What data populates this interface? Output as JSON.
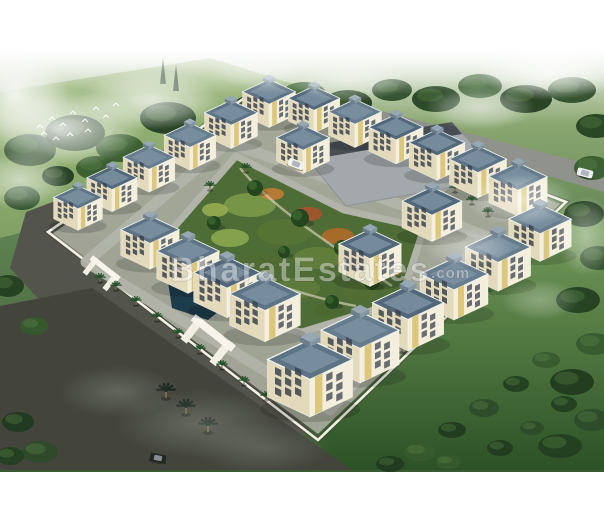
{
  "meta": {
    "width": 604,
    "height": 520
  },
  "watermark": {
    "text": "BharatEstates",
    "suffix": ".com"
  },
  "palette": {
    "bgTop": "#f3f6ef",
    "green1": "#8aa771",
    "green2": "#5d8150",
    "green3": "#49693e",
    "green4": "#3a5a33",
    "field": "#93b06f",
    "lawnLight": "#79a05e",
    "lawnDark": "#2c5126",
    "roadOuter": "#53544b",
    "roadDark": "#43453d",
    "roadNE": "#8f938b",
    "roadInner": "#b2b4aa",
    "ground": "#a4a89a",
    "wall": "#f2efe4",
    "parking": "#a2a8ab",
    "parkingDark": "#474e53",
    "garden": "#4e6c35",
    "pond": "#1d3c4b",
    "pondHi": "#2f5a6d",
    "path": "#d8d2bf",
    "cream": "#f4efdd",
    "creamShade": "#e3d9bb",
    "yellow": "#d9c271",
    "window": "#39424c",
    "roofs": [
      "#5d7486",
      "#51677a",
      "#667d8e"
    ],
    "parapet": "#7b91a1",
    "palm": "#235226",
    "palmDark": "#16251b",
    "cypress": "#1d3a1c",
    "treeFills": [
      "#2d4b29",
      "#223f20",
      "#365a2e",
      "#1f3a1e"
    ],
    "treeHi": "#5d8549",
    "smoke": "#9aa095",
    "bird": "#fdfdfb"
  },
  "scene": {
    "field": [
      [
        0,
        92
      ],
      [
        210,
        58
      ],
      [
        300,
        86
      ],
      [
        96,
        214
      ],
      [
        0,
        238
      ]
    ],
    "lawnRight": [
      [
        318,
        442
      ],
      [
        566,
        204
      ],
      [
        604,
        216
      ],
      [
        604,
        470
      ],
      [
        330,
        470
      ]
    ],
    "cypresses": [
      [
        163,
        70
      ],
      [
        176,
        77
      ]
    ],
    "roads": [
      {
        "p": [
          [
            26,
            212
          ],
          [
            58,
            200
          ],
          [
            310,
            430
          ],
          [
            258,
            468
          ],
          [
            196,
            470
          ],
          [
            10,
            268
          ]
        ],
        "f": "roadOuter"
      },
      {
        "p": [
          [
            0,
            306
          ],
          [
            92,
            288
          ],
          [
            352,
            470
          ],
          [
            0,
            470
          ]
        ],
        "f": "roadDark"
      },
      {
        "p": [
          [
            268,
            82
          ],
          [
            604,
            168
          ],
          [
            604,
            192
          ],
          [
            276,
            98
          ]
        ],
        "f": "roadNE"
      }
    ],
    "bgTrees": [
      [
        30,
        150,
        26,
        16
      ],
      [
        75,
        133,
        30,
        18
      ],
      [
        120,
        148,
        24,
        14
      ],
      [
        168,
        118,
        28,
        16
      ],
      [
        214,
        138,
        22,
        12
      ],
      [
        258,
        108,
        26,
        14
      ],
      [
        304,
        94,
        22,
        12
      ],
      [
        348,
        103,
        24,
        13
      ],
      [
        392,
        90,
        20,
        11
      ],
      [
        436,
        99,
        24,
        13
      ],
      [
        480,
        86,
        22,
        12
      ],
      [
        526,
        99,
        26,
        14
      ],
      [
        572,
        90,
        24,
        13
      ],
      [
        596,
        126,
        20,
        12
      ],
      [
        592,
        168,
        18,
        12
      ],
      [
        584,
        214,
        20,
        13
      ],
      [
        598,
        258,
        18,
        12
      ],
      [
        578,
        300,
        22,
        13
      ],
      [
        594,
        344,
        18,
        11
      ],
      [
        572,
        382,
        22,
        13
      ],
      [
        592,
        420,
        18,
        11
      ],
      [
        560,
        446,
        22,
        12
      ],
      [
        420,
        452,
        16,
        9
      ],
      [
        452,
        430,
        14,
        8
      ],
      [
        484,
        408,
        15,
        9
      ],
      [
        516,
        384,
        13,
        8
      ],
      [
        546,
        360,
        14,
        8
      ],
      [
        500,
        448,
        13,
        8
      ],
      [
        532,
        428,
        12,
        7
      ],
      [
        564,
        404,
        13,
        8
      ],
      [
        448,
        462,
        13,
        7
      ],
      [
        390,
        464,
        14,
        8
      ],
      [
        22,
        198,
        18,
        12
      ],
      [
        8,
        286,
        16,
        11
      ],
      [
        34,
        326,
        14,
        9
      ],
      [
        18,
        422,
        16,
        10
      ],
      [
        40,
        452,
        18,
        11
      ],
      [
        10,
        456,
        14,
        9
      ],
      [
        96,
        168,
        20,
        12
      ],
      [
        58,
        176,
        16,
        10
      ]
    ],
    "birds": [
      [
        40,
        127
      ],
      [
        52,
        119
      ],
      [
        63,
        125
      ],
      [
        73,
        113
      ],
      [
        85,
        121
      ],
      [
        96,
        109
      ],
      [
        106,
        117
      ],
      [
        116,
        105
      ],
      [
        88,
        131
      ],
      [
        70,
        135
      ],
      [
        56,
        139
      ],
      [
        44,
        134
      ]
    ],
    "wall": [
      [
        48,
        232
      ],
      [
        262,
        86
      ],
      [
        566,
        202
      ],
      [
        318,
        440
      ]
    ],
    "ground": [
      [
        52,
        234
      ],
      [
        262,
        90
      ],
      [
        560,
        204
      ],
      [
        318,
        434
      ]
    ],
    "ringRoad": [
      [
        228,
        142
      ],
      [
        486,
        236
      ],
      [
        330,
        410
      ],
      [
        86,
        262
      ]
    ],
    "parking": [
      [
        300,
        150
      ],
      [
        456,
        126
      ],
      [
        502,
        178
      ],
      [
        346,
        206
      ]
    ],
    "parkingDark": [
      [
        298,
        148
      ],
      [
        452,
        122
      ],
      [
        462,
        134
      ],
      [
        308,
        160
      ]
    ],
    "garden": [
      [
        236,
        156
      ],
      [
        344,
        210
      ],
      [
        424,
        228
      ],
      [
        400,
        302
      ],
      [
        302,
        332
      ],
      [
        238,
        320
      ],
      [
        156,
        248
      ]
    ],
    "pond": [
      [
        168,
        282
      ],
      [
        212,
        268
      ],
      [
        238,
        296
      ],
      [
        208,
        320
      ],
      [
        172,
        308
      ]
    ],
    "gardenPatches": [
      [
        250,
        205,
        26,
        12,
        "#7c9a48"
      ],
      [
        285,
        232,
        28,
        13,
        "#587436"
      ],
      [
        318,
        258,
        24,
        11,
        "#637f3b"
      ],
      [
        230,
        238,
        19,
        9,
        "#8ba84e"
      ],
      [
        262,
        264,
        21,
        10,
        "#506b31"
      ],
      [
        298,
        288,
        22,
        10,
        "#5e7c3a"
      ],
      [
        338,
        236,
        16,
        8,
        "#b06a28"
      ],
      [
        308,
        214,
        14,
        7,
        "#a8542b"
      ],
      [
        272,
        194,
        12,
        6,
        "#c07c32"
      ],
      [
        352,
        262,
        14,
        7,
        "#9e4a2c"
      ],
      [
        242,
        284,
        16,
        8,
        "#7d9a46"
      ],
      [
        360,
        292,
        18,
        8,
        "#546f33"
      ],
      [
        388,
        270,
        14,
        7,
        "#b5823a"
      ],
      [
        330,
        310,
        16,
        7,
        "#4e6830"
      ],
      [
        215,
        210,
        13,
        7,
        "#97ad52"
      ],
      [
        370,
        240,
        12,
        6,
        "#c9552e"
      ]
    ],
    "gardenTrees": [
      [
        255,
        188,
        8
      ],
      [
        300,
        218,
        9
      ],
      [
        342,
        248,
        8
      ],
      [
        228,
        262,
        7
      ],
      [
        214,
        223,
        7
      ],
      [
        372,
        282,
        8
      ],
      [
        332,
        302,
        7
      ],
      [
        284,
        252,
        6
      ],
      [
        260,
        300,
        7
      ]
    ],
    "walkways": [
      "M240,168 C270,205 320,238 392,286",
      "M170,252 C230,268 300,296 356,306"
    ],
    "gates": [
      {
        "x": 96,
        "y": 280,
        "a": 38,
        "s": 1.1
      },
      {
        "x": 200,
        "y": 350,
        "a": 38,
        "s": 1.6
      }
    ],
    "palms": [
      [
        116,
        290
      ],
      [
        136,
        305
      ],
      [
        157,
        321
      ],
      [
        178,
        337
      ],
      [
        200,
        353
      ],
      [
        222,
        369
      ],
      [
        244,
        385
      ],
      [
        266,
        400
      ],
      [
        318,
        404
      ],
      [
        346,
        388
      ],
      [
        374,
        370
      ],
      [
        402,
        352
      ],
      [
        430,
        334
      ],
      [
        458,
        315
      ],
      [
        486,
        296
      ],
      [
        512,
        277
      ],
      [
        455,
        192
      ],
      [
        472,
        204
      ],
      [
        488,
        216
      ],
      [
        100,
        282
      ],
      [
        246,
        172
      ],
      [
        210,
        190
      ]
    ],
    "darkPalms": [
      [
        186,
        414
      ],
      [
        208,
        432
      ],
      [
        166,
        398
      ]
    ],
    "buildings": [
      [
        78,
        216,
        0.72
      ],
      [
        112,
        197,
        0.74
      ],
      [
        149,
        177,
        0.76
      ],
      [
        190,
        155,
        0.76
      ],
      [
        231,
        133,
        0.78
      ],
      [
        269,
        112,
        0.78
      ],
      [
        314,
        118,
        0.76
      ],
      [
        355,
        132,
        0.78
      ],
      [
        396,
        148,
        0.8
      ],
      [
        437,
        164,
        0.82
      ],
      [
        478,
        181,
        0.84
      ],
      [
        518,
        199,
        0.86
      ],
      [
        303,
        158,
        0.78
      ],
      [
        432,
        224,
        0.88
      ],
      [
        370,
        268,
        0.92
      ],
      [
        540,
        243,
        0.92
      ],
      [
        498,
        272,
        0.96
      ],
      [
        454,
        300,
        1.0
      ],
      [
        408,
        330,
        1.05
      ],
      [
        360,
        360,
        1.15
      ],
      [
        310,
        392,
        1.25
      ],
      [
        150,
        252,
        0.86
      ],
      [
        188,
        275,
        0.92
      ],
      [
        227,
        298,
        0.98
      ],
      [
        265,
        321,
        1.04
      ]
    ],
    "cars": [
      {
        "x": 296,
        "y": 164,
        "c": "#f2f2ee",
        "a": 21
      },
      {
        "x": 585,
        "y": 173,
        "c": "#eceeec",
        "a": 14
      },
      {
        "x": 158,
        "y": 458,
        "c": "#23261f",
        "a": 10
      }
    ],
    "mist": [
      [
        60,
        128,
        85,
        40,
        0.85,
        0
      ],
      [
        150,
        100,
        70,
        30,
        0.75,
        0
      ],
      [
        15,
        95,
        55,
        45,
        0.9,
        0
      ],
      [
        20,
        180,
        50,
        30,
        0.6,
        0
      ],
      [
        548,
        72,
        70,
        28,
        0.8,
        0
      ],
      [
        480,
        108,
        55,
        22,
        0.55,
        0
      ],
      [
        350,
        80,
        60,
        22,
        0.5,
        0
      ],
      [
        260,
        70,
        50,
        18,
        0.45,
        0
      ],
      [
        520,
        200,
        55,
        26,
        0.5,
        0
      ],
      [
        468,
        248,
        45,
        20,
        0.4,
        0
      ],
      [
        586,
        236,
        30,
        40,
        0.45,
        0
      ],
      [
        540,
        300,
        40,
        20,
        0.3,
        0
      ],
      [
        200,
        424,
        85,
        34,
        0.5,
        1
      ],
      [
        118,
        392,
        60,
        26,
        0.45,
        1
      ],
      [
        262,
        448,
        70,
        26,
        0.4,
        1
      ]
    ]
  }
}
